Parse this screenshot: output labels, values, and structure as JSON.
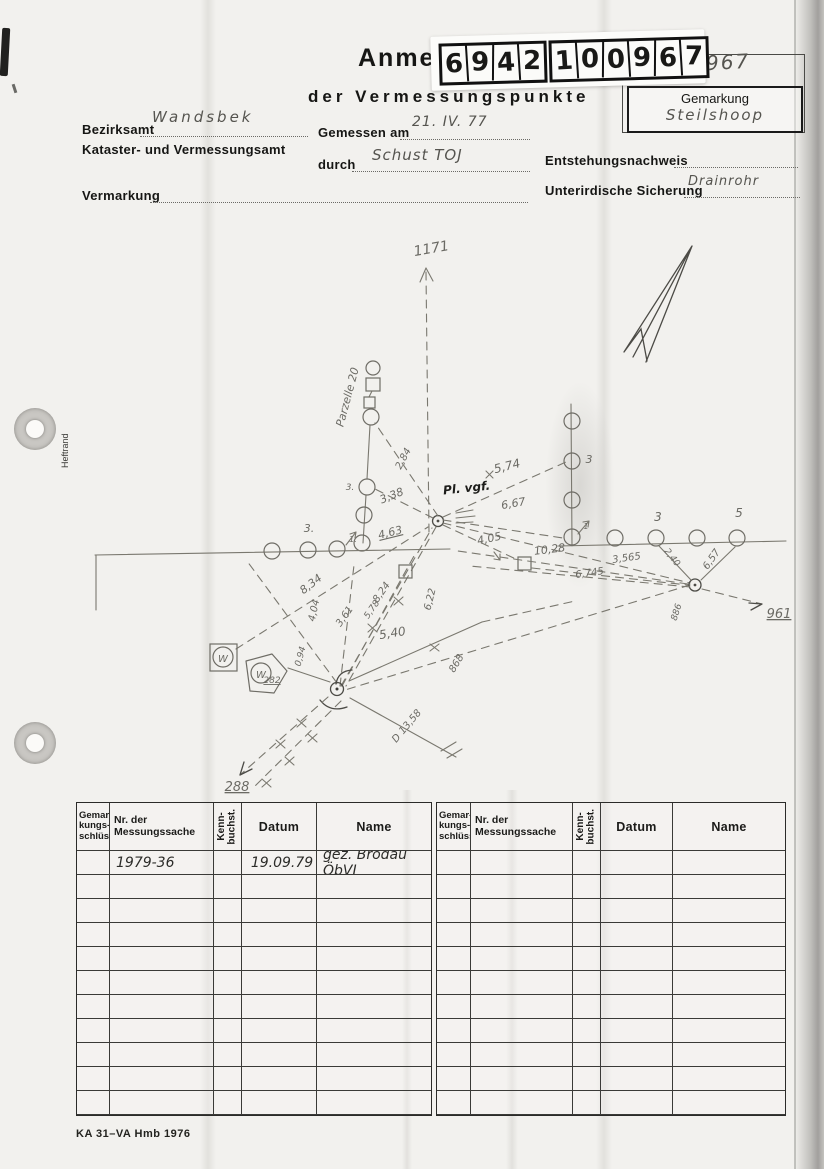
{
  "header": {
    "title_partial": "Anme",
    "title_line2": "der Vermessungspunkte",
    "sticker_digits_group1": [
      "6",
      "9",
      "4",
      "2"
    ],
    "sticker_digits_group2": [
      "1",
      "0",
      "0",
      "9",
      "6",
      "7"
    ],
    "faint_label": "Punkt-Nr.",
    "point_number_handwritten": "967",
    "gemarkung_label": "Gemarkung",
    "gemarkung_value": "Steilshoop"
  },
  "form": {
    "bezirksamt_label": "Bezirksamt",
    "bezirksamt_value": "Wandsbek",
    "amt_line2": "Kataster- und Vermessungsamt",
    "gemessen_am_label": "Gemessen am",
    "gemessen_am_value": "21. IV. 77",
    "durch_label": "durch",
    "durch_value": "Schust TOJ",
    "vermarkung_label": "Vermarkung",
    "entstehungsnachweis_label": "Entstehungsnachweis",
    "unterirdische_sicherung_label": "Unterirdische Sicherung",
    "unterirdische_sicherung_value": "Drainrohr"
  },
  "page": {
    "margin_label": "Heftrand",
    "form_code": "KA 31–VA Hmb 1976"
  },
  "sketch": {
    "labels": [
      {
        "text": "1171",
        "x": 432,
        "y": 253,
        "rot": -10,
        "size": 14
      },
      {
        "text": "Parzelle 20",
        "x": 351,
        "y": 398,
        "rot": -75,
        "size": 11
      },
      {
        "text": "2,84",
        "x": 406,
        "y": 460,
        "rot": -62,
        "size": 10
      },
      {
        "text": "3,38",
        "x": 393,
        "y": 499,
        "rot": -22,
        "size": 11
      },
      {
        "text": "Pl. vgf.",
        "x": 467,
        "y": 492,
        "rot": -6,
        "size": 12,
        "cls": "ink"
      },
      {
        "text": "5,74",
        "x": 508,
        "y": 470,
        "rot": -14,
        "size": 12
      },
      {
        "text": "6,67",
        "x": 514,
        "y": 507,
        "rot": -10,
        "size": 11
      },
      {
        "text": "4,05",
        "x": 490,
        "y": 542,
        "rot": -12,
        "size": 11
      },
      {
        "text": "10,28",
        "x": 550,
        "y": 553,
        "rot": -7,
        "size": 11
      },
      {
        "text": "4,63",
        "x": 391,
        "y": 536,
        "rot": -14,
        "size": 11,
        "ul": true
      },
      {
        "text": "3.",
        "x": 309,
        "y": 532,
        "size": 11
      },
      {
        "text": "3.",
        "x": 350,
        "y": 490,
        "size": 9
      },
      {
        "text": "1.",
        "x": 353,
        "y": 542,
        "size": 8
      },
      {
        "text": "1",
        "x": 586,
        "y": 529,
        "size": 8
      },
      {
        "text": "3",
        "x": 589,
        "y": 463,
        "size": 11
      },
      {
        "text": "3",
        "x": 658,
        "y": 521,
        "size": 12
      },
      {
        "text": "5",
        "x": 739,
        "y": 517,
        "size": 12
      },
      {
        "text": "2,40",
        "x": 670,
        "y": 559,
        "rot": 52,
        "size": 9
      },
      {
        "text": "6,57",
        "x": 714,
        "y": 561,
        "rot": -55,
        "size": 10
      },
      {
        "text": "3,565",
        "x": 627,
        "y": 561,
        "rot": -8,
        "size": 10
      },
      {
        "text": "6,745",
        "x": 590,
        "y": 576,
        "rot": -8,
        "size": 10
      },
      {
        "text": "886",
        "x": 679,
        "y": 613,
        "rot": -72,
        "size": 9
      },
      {
        "text": "961",
        "x": 779,
        "y": 618,
        "size": 13,
        "ul": true
      },
      {
        "text": "868",
        "x": 459,
        "y": 665,
        "rot": -58,
        "size": 10
      },
      {
        "text": "8,34",
        "x": 313,
        "y": 587,
        "rot": -38,
        "size": 11
      },
      {
        "text": "4,04",
        "x": 317,
        "y": 611,
        "rot": -78,
        "size": 10
      },
      {
        "text": "3,61",
        "x": 347,
        "y": 618,
        "rot": -55,
        "size": 10
      },
      {
        "text": "8,24",
        "x": 384,
        "y": 594,
        "rot": -55,
        "size": 10
      },
      {
        "text": "5,78",
        "x": 374,
        "y": 611,
        "rot": -55,
        "size": 9
      },
      {
        "text": "6,22",
        "x": 433,
        "y": 600,
        "rot": -76,
        "size": 10
      },
      {
        "text": "5,40",
        "x": 393,
        "y": 637,
        "rot": -9,
        "size": 12
      },
      {
        "text": "0,94",
        "x": 303,
        "y": 657,
        "rot": -75,
        "size": 9
      },
      {
        "text": "282",
        "x": 272,
        "y": 683,
        "size": 9,
        "ul": true
      },
      {
        "text": "288",
        "x": 237,
        "y": 791,
        "size": 13,
        "ul": true
      },
      {
        "text": "D 13,58",
        "x": 409,
        "y": 728,
        "rot": -50,
        "size": 10
      },
      {
        "text": "W",
        "x": 223,
        "y": 662,
        "size": 10
      },
      {
        "text": "W",
        "x": 261,
        "y": 678,
        "size": 10
      }
    ]
  },
  "table": {
    "row_count": 11,
    "headers": {
      "gemar": "Gemar-\nkungs-\nschlüssel",
      "nr": "Nr. der\nMessungssache",
      "kenn": "Kenn-\nbuchst.",
      "datum": "Datum",
      "name": "Name"
    },
    "left_entries": [
      {
        "row": 0,
        "nr": "1979-36",
        "datum": "19.09.79",
        "name": "gez. Brödau ÖbVI"
      }
    ],
    "right_entries": []
  }
}
